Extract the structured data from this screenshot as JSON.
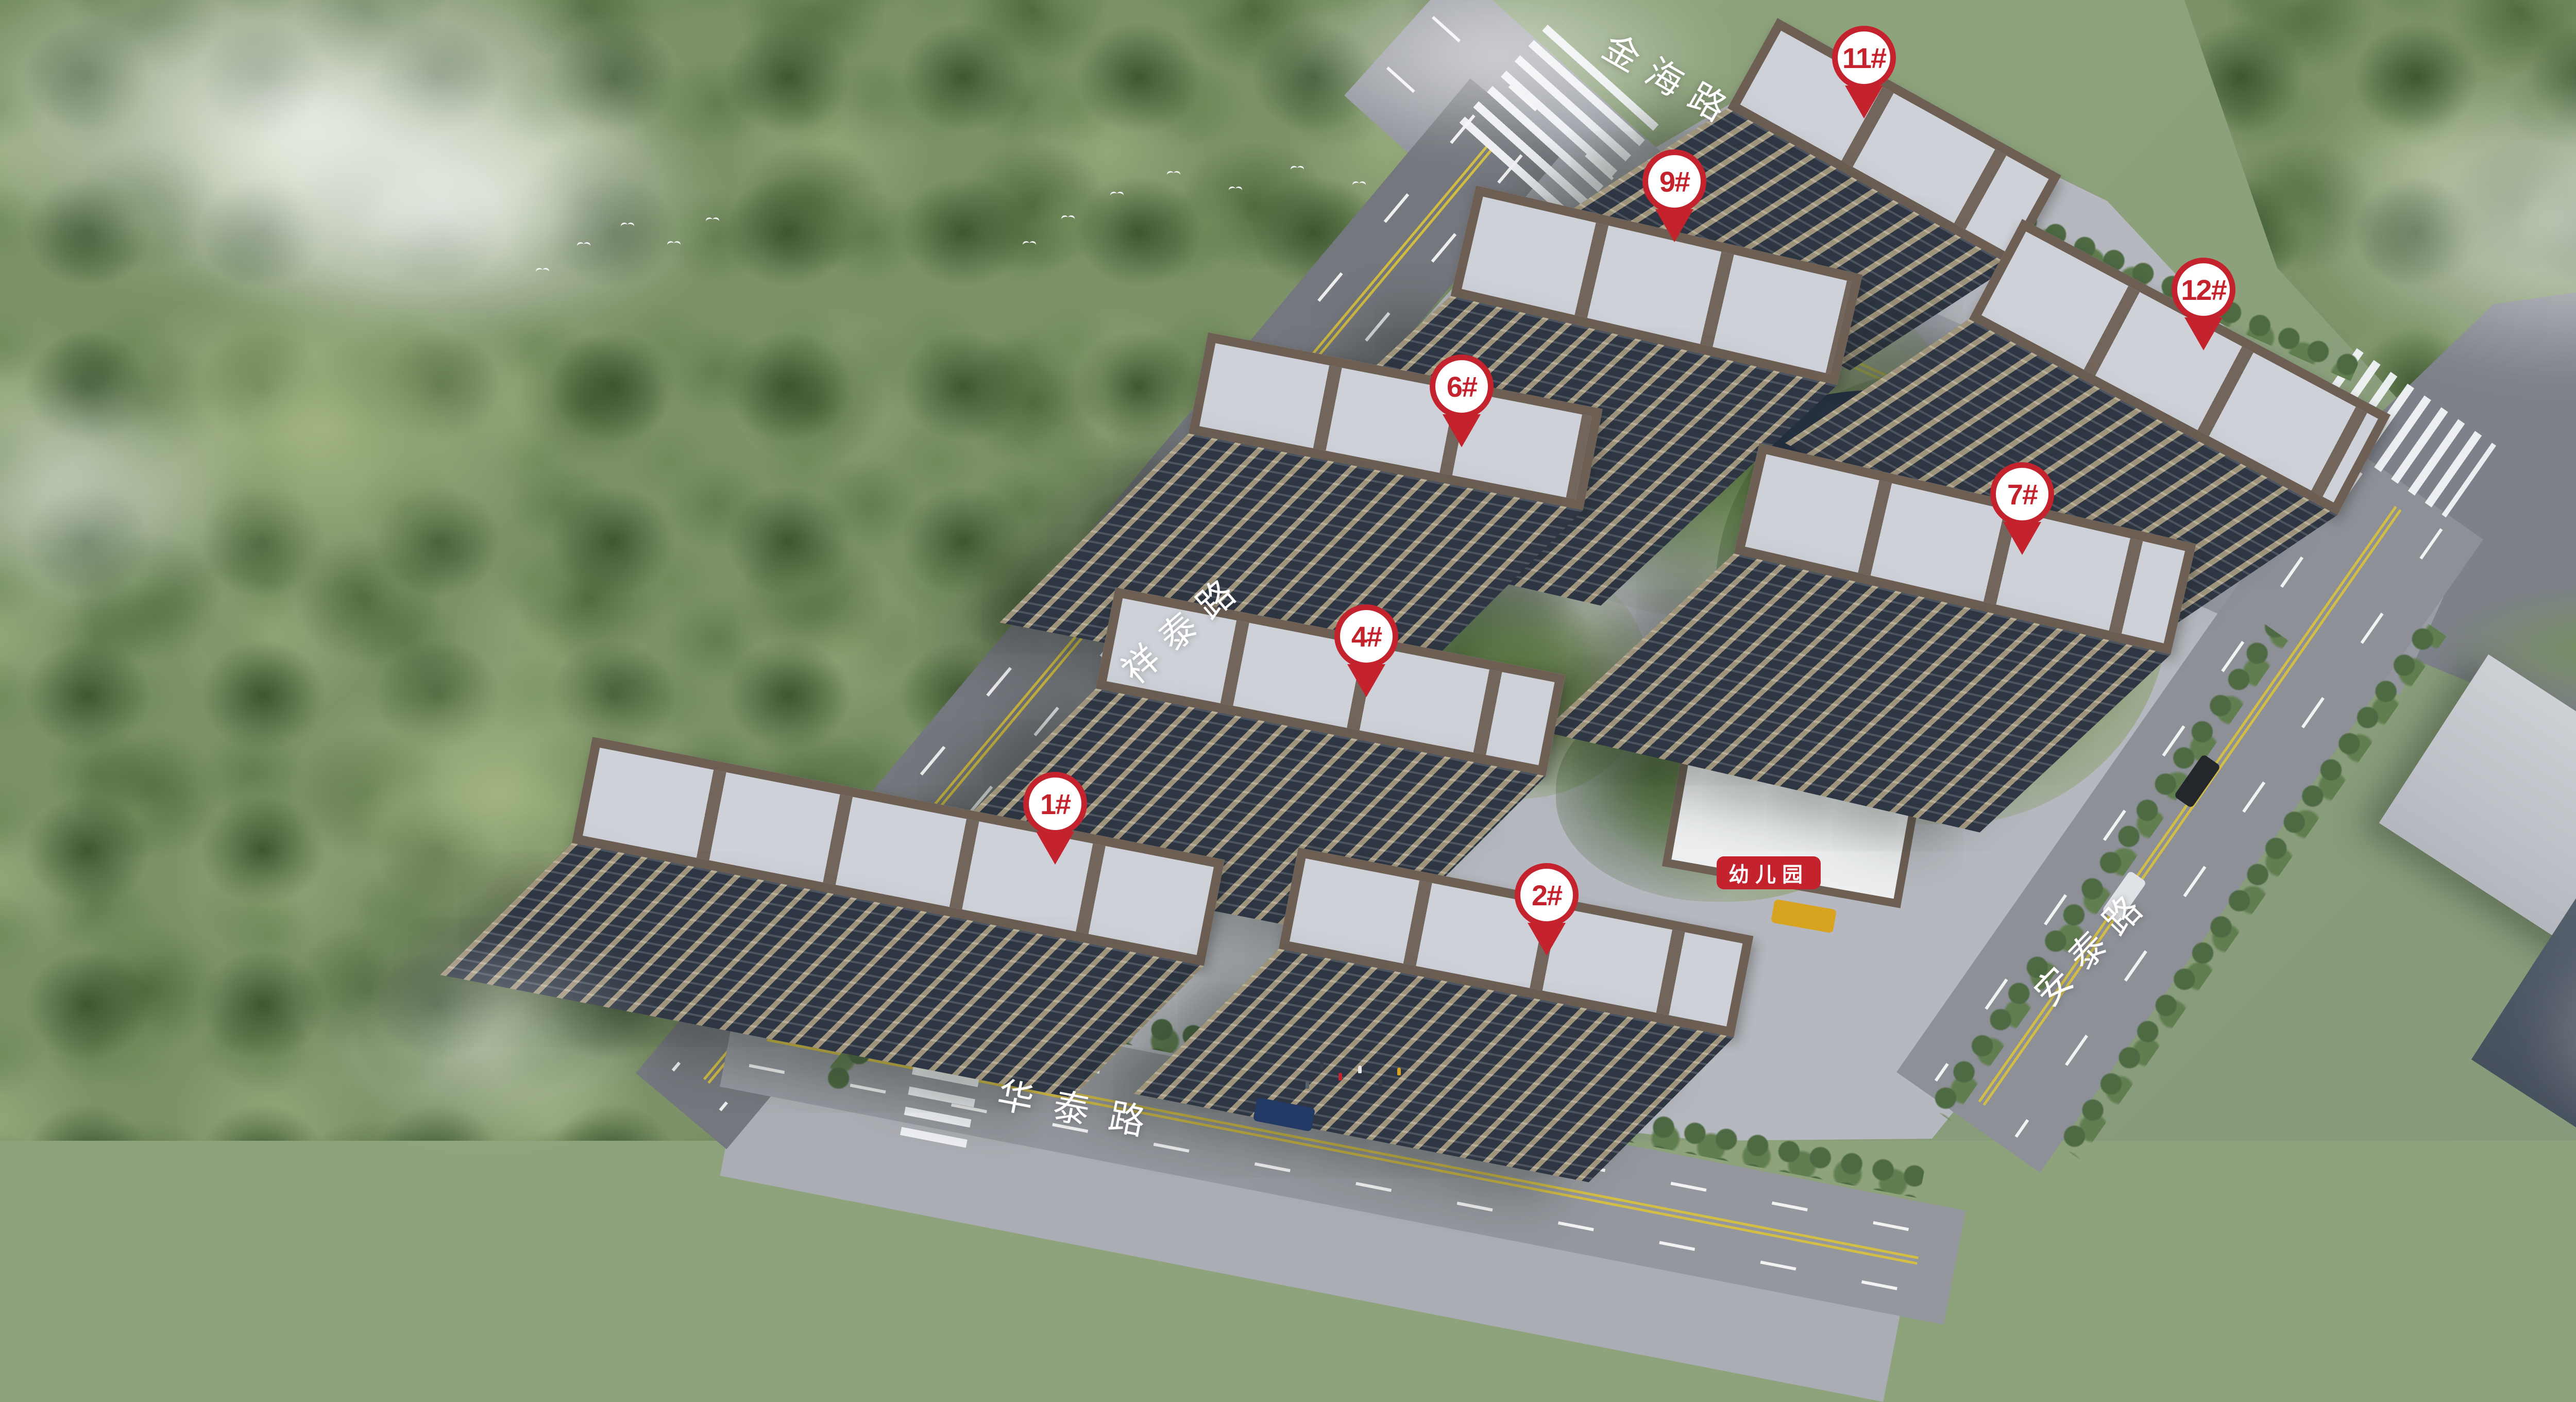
{
  "scene": {
    "caption": "鸟瞰图"
  },
  "markers": [
    {
      "label": "1#"
    },
    {
      "label": "2#"
    },
    {
      "label": "4#"
    },
    {
      "label": "6#"
    },
    {
      "label": "7#"
    },
    {
      "label": "9#"
    },
    {
      "label": "11#"
    },
    {
      "label": "12#"
    }
  ],
  "roads": {
    "jinhai": {
      "label": "金海路"
    },
    "xiangtai": {
      "label": "祥泰路"
    },
    "antai": {
      "label": "安泰路"
    },
    "huatai": {
      "label": "华泰路"
    }
  },
  "facilities": {
    "kindergarten": {
      "label": "幼儿园"
    }
  },
  "colors": {
    "marker_red": "#c4232d",
    "road_label_white": "#ffffff",
    "caption_white": "#f2f4f6"
  }
}
